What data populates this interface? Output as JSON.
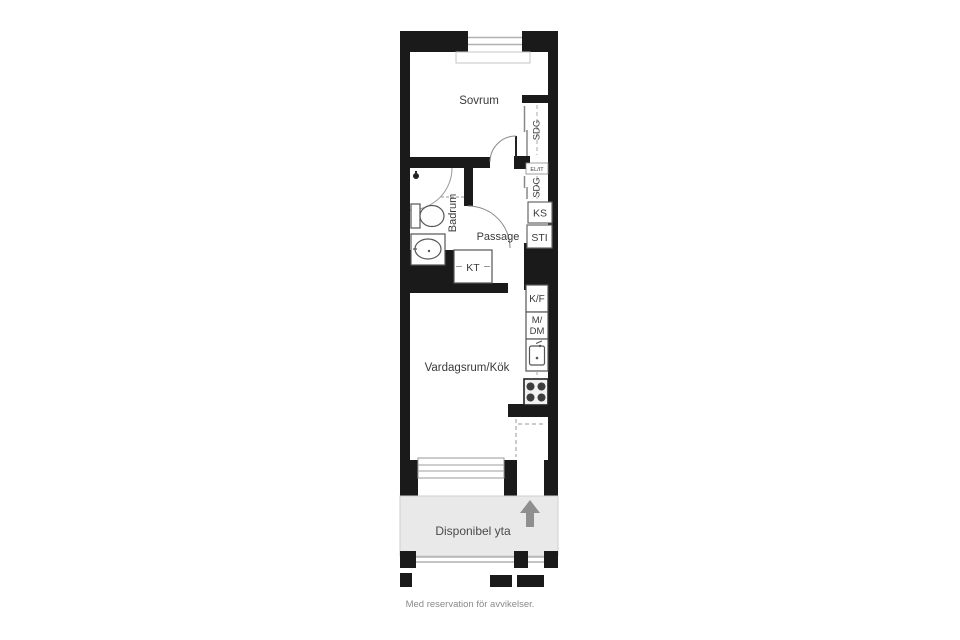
{
  "floorplan": {
    "rooms": {
      "bedroom": "Sovrum",
      "bathroom": "Badrum",
      "hall": "Passage",
      "living_kitchen": "Vardagsrum/Kök",
      "available_area": "Disponibel yta"
    },
    "fixtures": {
      "wardrobe_top": "SDG",
      "wardrobe_mid": "SDG",
      "electrical_panel": "EL/IT",
      "ks_cabinet": "KS",
      "sti_cabinet": "STI",
      "kt_unit": "KT",
      "fridge_freezer": "K/F",
      "micro_dishwasher_line1": "M/",
      "micro_dishwasher_line2": "DM"
    },
    "footer": "Med reservation för avvikelser.",
    "colors": {
      "wall": "#1a1a1a",
      "available_area_fill": "#e9e9e9",
      "entry_arrow": "#8f8f8f",
      "window_line": "#b0b0b0"
    }
  }
}
